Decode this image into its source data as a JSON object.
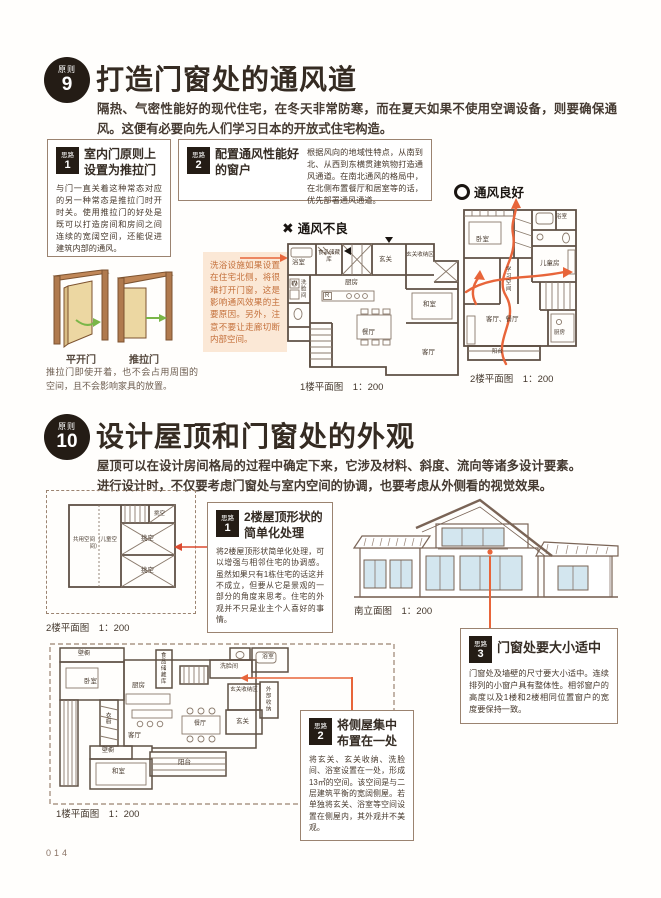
{
  "colors": {
    "accent_orange": "#E8653A",
    "arrow_red": "#DC4A2F",
    "badge_black": "#241C15",
    "box_border": "#9B8370",
    "annotation_bg": "#FBE8D6",
    "annotation_text": "#C4703B",
    "wood_brown": "#B07A4E",
    "door_panel": "#ECD7A2",
    "green_arrow": "#7AB648",
    "window_blue": "#D3E6EF",
    "plan_line": "#5F5045"
  },
  "page": {
    "number": "014"
  },
  "principle9": {
    "badge": {
      "label": "原则",
      "number": "9"
    },
    "title": "打造门窗处的通风道",
    "intro": "隔热、气密性能好的现代住宅，在冬天非常防寒，而在夏天如果不使用空调设备，则要确保通风。这便有必要向先人们学习日本的开放式住宅构造。",
    "idea1": {
      "badge_label": "思路",
      "badge_number": "1",
      "heading": "室内门原则上设置为推拉门",
      "body": "与门一直关着这种常态对应的另一种常态是推拉门时开时关。使用推拉门的好处是既可以打造房间和房间之间连续的宽阔空间，还能促进建筑内部的通风。"
    },
    "idea2": {
      "badge_label": "思路",
      "badge_number": "2",
      "heading": "配置通风性能好的窗户",
      "body": "根据风向的地域性特点，从南到北、从西到东横贯建筑物打造通风通道。在南北通风的格局中，在北侧布置餐厅和居室等的话，优先部署通风通道。"
    },
    "annotation": "洗浴设施如果设置在住宅北侧，将很难打开门窗，这是影响通风效果的主要原因。另外，注意不要让走廊切断内部空间。",
    "vent_bad": {
      "icon": "✖",
      "label": "通风不良"
    },
    "vent_good": {
      "label": "通风良好"
    },
    "doors": {
      "hinged_label": "平开门",
      "sliding_label": "推拉门",
      "caption": "推拉门即使开着，也不会占用周围的空间，且不会影响家具的放置。"
    },
    "plan1": {
      "caption": "1楼平面图　1：200",
      "fridge": "R",
      "washer": "W",
      "rooms": [
        "浴室",
        "食品储藏库",
        "玄关",
        "玄关收纳区",
        "洗脸间",
        "厨房",
        "和室",
        "餐厅",
        "客厅"
      ]
    },
    "plan2": {
      "caption": "2楼平面图　1：200",
      "rooms": [
        "卧室",
        "浴室",
        "儿童房",
        "学习空间",
        "客厅、餐厅",
        "厨房",
        "阳台"
      ]
    }
  },
  "principle10": {
    "badge": {
      "label": "原则",
      "number": "10"
    },
    "title": "设计屋顶和门窗处的外观",
    "intro": "屋顶可以在设计房间格局的过程中确定下来，它涉及材料、斜度、流向等诸多设计要素。进行设计时，不仅要考虑门窗处与室内空间的协调，也要考虑从外侧看的视觉效果。",
    "idea1": {
      "badge_label": "思路",
      "badge_number": "1",
      "heading": "2楼屋顶形状的简单化处理",
      "body": "将2楼屋顶形状简单化处理，可以增强与相邻住宅的协调感。虽然如果只有1栋住宅的话这并不成立，但要从它是景观的一部分的角度来思考。住宅的外观并不只是业主个人喜好的事情。"
    },
    "idea2": {
      "badge_label": "思路",
      "badge_number": "2",
      "heading": "将侧屋集中布置在一处",
      "body": "将玄关、玄关收纳、洗脸间、浴室设置在一处，形成13㎡的空间。该空间是与二层建筑平衡的宽阔侧屋。若单独将玄关、浴室等空间设置在侧屋内，其外观并不美观。"
    },
    "idea3": {
      "badge_label": "思路",
      "badge_number": "3",
      "heading": "门窗处要大小适中",
      "body": "门窗处及墙壁的尺寸要大小适中。连续排列的小窗户具有整体性。相邻窗户的高度以及1楼和2楼相同位置窗户的宽度要保持一致。"
    },
    "plan2f": {
      "caption": "2楼平面图　1：200",
      "rooms": [
        "共用空间（儿童空间）",
        "挑空",
        "挑空",
        "挑空"
      ]
    },
    "elevation": {
      "caption": "南立面图　1：200"
    },
    "plan1f": {
      "caption": "1楼平面图　1：200",
      "rooms": [
        "壁橱",
        "卧室",
        "衣橱",
        "厨房",
        "客厅",
        "餐厅",
        "壁橱",
        "和室",
        "阳台",
        "食品储藏库",
        "洗脸间",
        "浴室",
        "玄关收纳区",
        "玄关",
        "外部收纳"
      ]
    }
  }
}
